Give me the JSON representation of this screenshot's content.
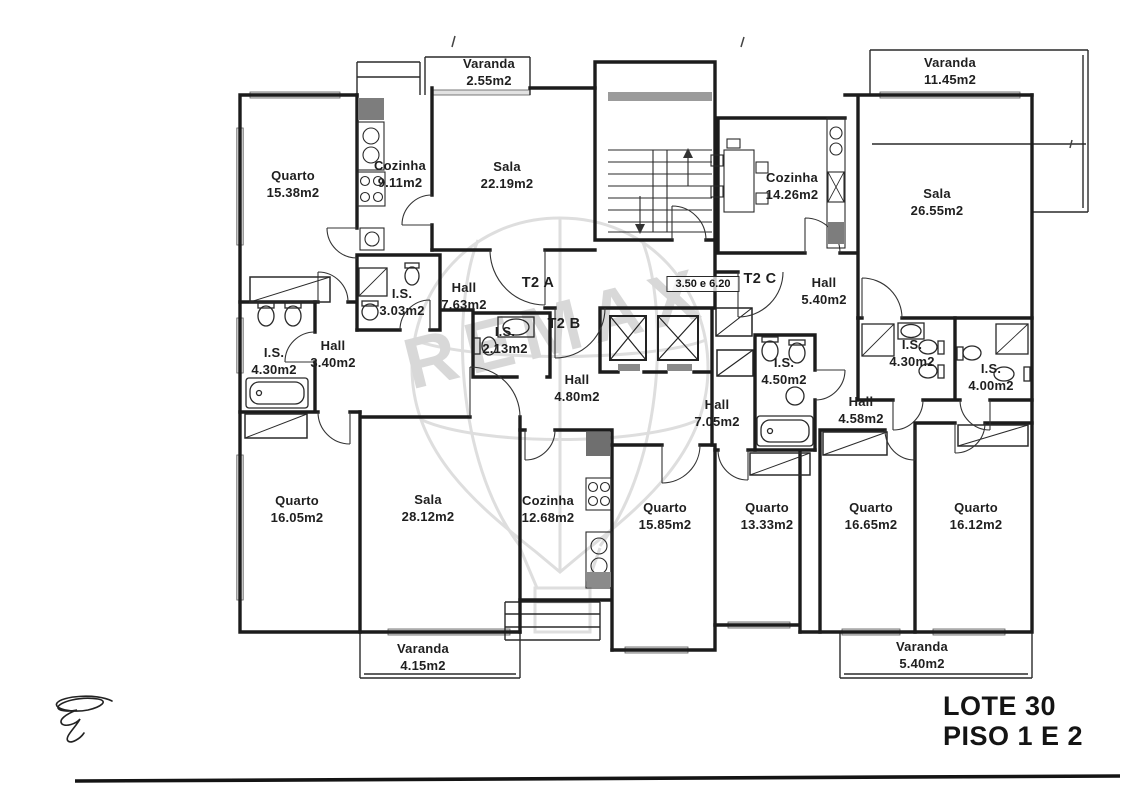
{
  "title": {
    "line1": "LOTE 30",
    "line2": "PISO 1 E 2"
  },
  "watermark": {
    "text": "REMAX"
  },
  "annotations": {
    "unit_a": "T2 A",
    "unit_b": "T2 B",
    "unit_c": "T2 C",
    "stair_note": "3.50 e 6.20"
  },
  "rooms": [
    {
      "name": "Quarto",
      "area": "15.38m2"
    },
    {
      "name": "Cozinha",
      "area": "9.11m2"
    },
    {
      "name": "Sala",
      "area": "22.19m2"
    },
    {
      "name": "Varanda",
      "area": "2.55m2"
    },
    {
      "name": "Varanda",
      "area": "11.45m2"
    },
    {
      "name": "Cozinha",
      "area": "14.26m2"
    },
    {
      "name": "Sala",
      "area": "26.55m2"
    },
    {
      "name": "Hall",
      "area": "7.63m2"
    },
    {
      "name": "I.S.",
      "area": "3.03m2"
    },
    {
      "name": "I.S.",
      "area": "2.13m2"
    },
    {
      "name": "Hall",
      "area": "3.40m2"
    },
    {
      "name": "I.S.",
      "area": "4.30m2"
    },
    {
      "name": "Hall",
      "area": "4.80m2"
    },
    {
      "name": "Hall",
      "area": "5.40m2"
    },
    {
      "name": "I.S.",
      "area": "4.50m2"
    },
    {
      "name": "I.S.",
      "area": "4.30m2"
    },
    {
      "name": "I.S.",
      "area": "4.00m2"
    },
    {
      "name": "Hall",
      "area": "7.05m2"
    },
    {
      "name": "Hall",
      "area": "4.58m2"
    },
    {
      "name": "Quarto",
      "area": "16.05m2"
    },
    {
      "name": "Sala",
      "area": "28.12m2"
    },
    {
      "name": "Cozinha",
      "area": "12.68m2"
    },
    {
      "name": "Quarto",
      "area": "15.85m2"
    },
    {
      "name": "Quarto",
      "area": "13.33m2"
    },
    {
      "name": "Quarto",
      "area": "16.65m2"
    },
    {
      "name": "Quarto",
      "area": "16.12m2"
    },
    {
      "name": "Varanda",
      "area": "4.15m2"
    },
    {
      "name": "Varanda",
      "area": "5.40m2"
    }
  ]
}
